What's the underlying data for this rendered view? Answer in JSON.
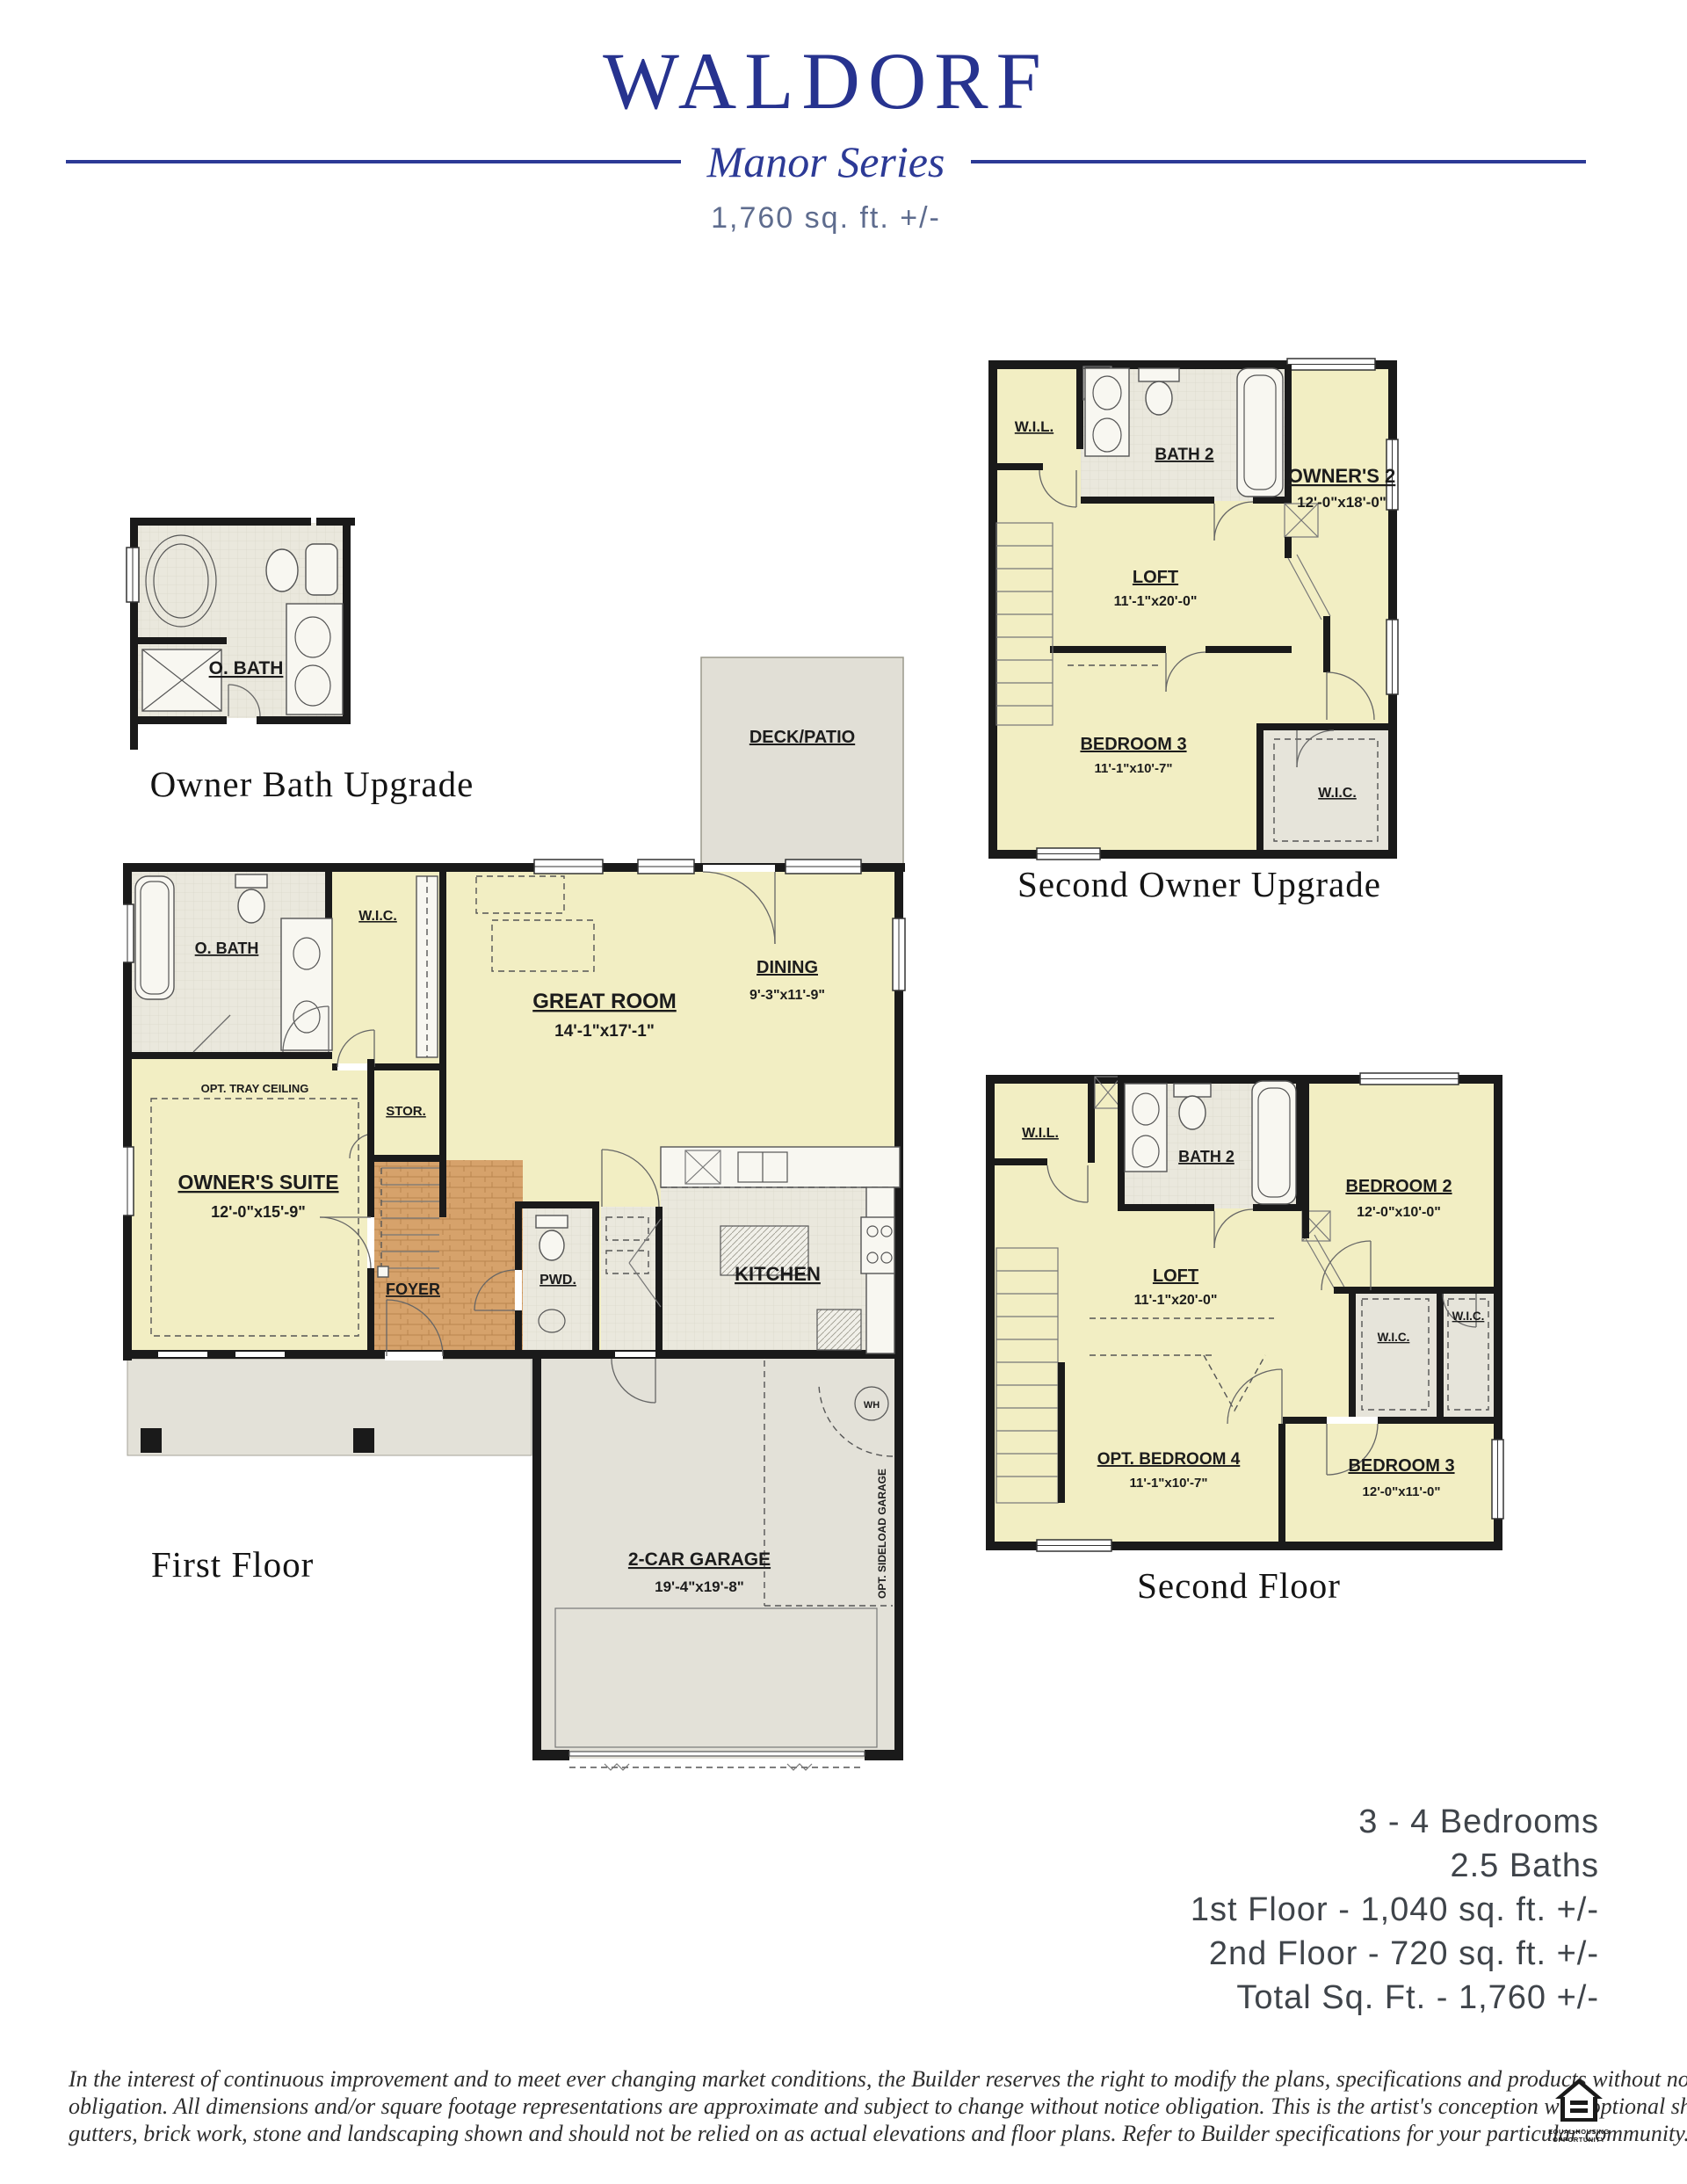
{
  "header": {
    "title": "WALDORF",
    "series": "Manor Series",
    "sqft": "1,760 sq. ft. +/-"
  },
  "colors": {
    "accent_navy": "#27338f",
    "subtitle_blue": "#5e6c8e",
    "room_yellow": "#f2eec3",
    "surface_gray": "#e3e1d8",
    "tile_gray": "#eae8dd",
    "wood_tan": "#d6a26b",
    "wall_black": "#1a1a1a"
  },
  "plans": {
    "owner_bath_upgrade": {
      "caption": "Owner Bath Upgrade",
      "obath": "O. BATH"
    },
    "second_owner_upgrade": {
      "caption": "Second Owner Upgrade",
      "wil": "W.I.L.",
      "bath2": "BATH 2",
      "owners2": "OWNER'S 2",
      "owners2_dim": "12'-0\"x18'-0\"",
      "loft": "LOFT",
      "loft_dim": "11'-1\"x20'-0\"",
      "bed3": "BEDROOM 3",
      "bed3_dim": "11'-1\"x10'-7\"",
      "wic": "W.I.C."
    },
    "first_floor": {
      "caption": "First Floor",
      "deck": "DECK/PATIO",
      "obath": "O. BATH",
      "wic": "W.I.C.",
      "great": "GREAT ROOM",
      "great_dim": "14'-1\"x17'-1\"",
      "dining": "DINING",
      "dining_dim": "9'-3\"x11'-9\"",
      "tray": "OPT. TRAY CEILING",
      "suite": "OWNER'S SUITE",
      "suite_dim": "12'-0\"x15'-9\"",
      "stor": "STOR.",
      "foyer": "FOYER",
      "pwd": "PWD.",
      "kitchen": "KITCHEN",
      "garage": "2-CAR GARAGE",
      "garage_dim": "19'-4\"x19'-8\"",
      "sideload": "OPT. SIDELOAD GARAGE",
      "wh": "WH"
    },
    "second_floor": {
      "caption": "Second Floor",
      "wil": "W.I.L.",
      "bath2": "BATH 2",
      "bed2": "BEDROOM 2",
      "bed2_dim": "12'-0\"x10'-0\"",
      "loft": "LOFT",
      "loft_dim": "11'-1\"x20'-0\"",
      "wic1": "W.I.C.",
      "wic2": "W.I.C.",
      "bed4": "OPT. BEDROOM 4",
      "bed4_dim": "11'-1\"x10'-7\"",
      "bed3": "BEDROOM 3",
      "bed3_dim": "12'-0\"x11'-0\""
    }
  },
  "stats": {
    "lines": [
      "3 - 4 Bedrooms",
      "2.5 Baths",
      "1st Floor - 1,040 sq. ft. +/-",
      "2nd Floor - 720 sq. ft. +/-",
      "Total Sq. Ft. - 1,760 +/-"
    ]
  },
  "disclaimer": {
    "line1": "In the interest of continuous improvement and to meet ever changing market conditions, the Builder reserves the right to modify the plans,  specifications and products without notice",
    "line2": "obligation. All dimensions and/or square footage representations are approximate and subject to change without notice obligation. This is the artist's conception with optional shutters,",
    "line3": "gutters, brick work, stone and landscaping shown and should not be relied on as actual elevations and floor plans. Refer to Builder specifications for your particular community.",
    "code": "090125"
  },
  "eho": {
    "line1": "EQUAL HOUSING",
    "line2": "OPPORTUNITY"
  }
}
